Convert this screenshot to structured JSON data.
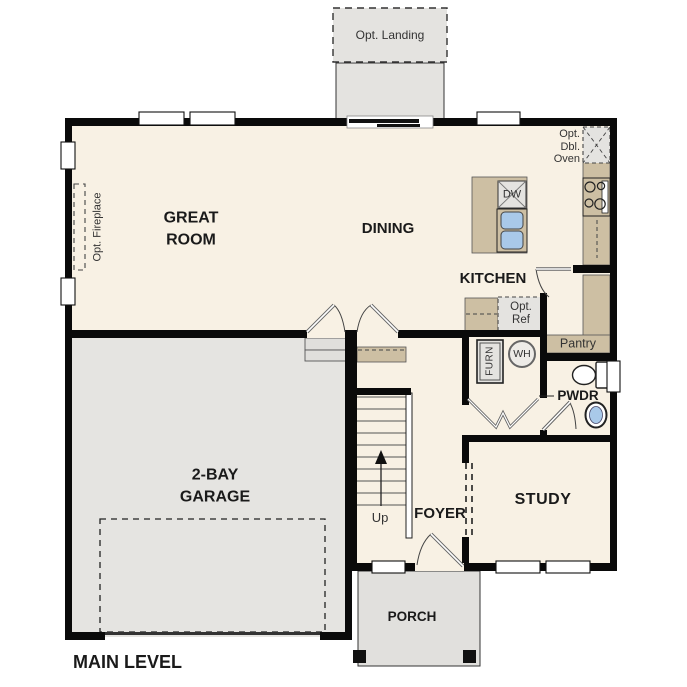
{
  "title": "MAIN LEVEL",
  "rooms": {
    "great_room": "GREAT\nROOM",
    "dining": "DINING",
    "kitchen": "KITCHEN",
    "garage": "2-BAY\nGARAGE",
    "study": "STUDY",
    "foyer": "FOYER",
    "porch": "PORCH",
    "pwdr": "PWDR",
    "pantry": "Pantry"
  },
  "annotations": {
    "opt_landing": "Opt. Landing",
    "opt_fireplace": "Opt. Fireplace",
    "opt_dbl_oven": "Opt.\nDbl.\nOven",
    "opt_ref": "Opt.\nRef",
    "dishwasher": "DW",
    "water_heater": "WH",
    "furnace": "FURN",
    "stairs_up": "Up"
  },
  "icons": {
    "range_symbol": "range-cooktop-icon",
    "sink_symbol": "double-sink-icon",
    "toilet_symbol": "toilet-icon",
    "lav_symbol": "lavatory-sink-icon",
    "water_heater_symbol": "water-heater-icon",
    "stairs_symbol": "stairs-up-arrow-icon"
  },
  "colors": {
    "floor": "#f8f1e4",
    "garage_floor": "#e5e4e1",
    "porch_floor": "#e1e0dd",
    "counter_tan": "#cdbfa3",
    "sink_blue": "#a9c9e9",
    "wall": "#0a0a0a",
    "optional_fill": "#e4e3e0"
  }
}
